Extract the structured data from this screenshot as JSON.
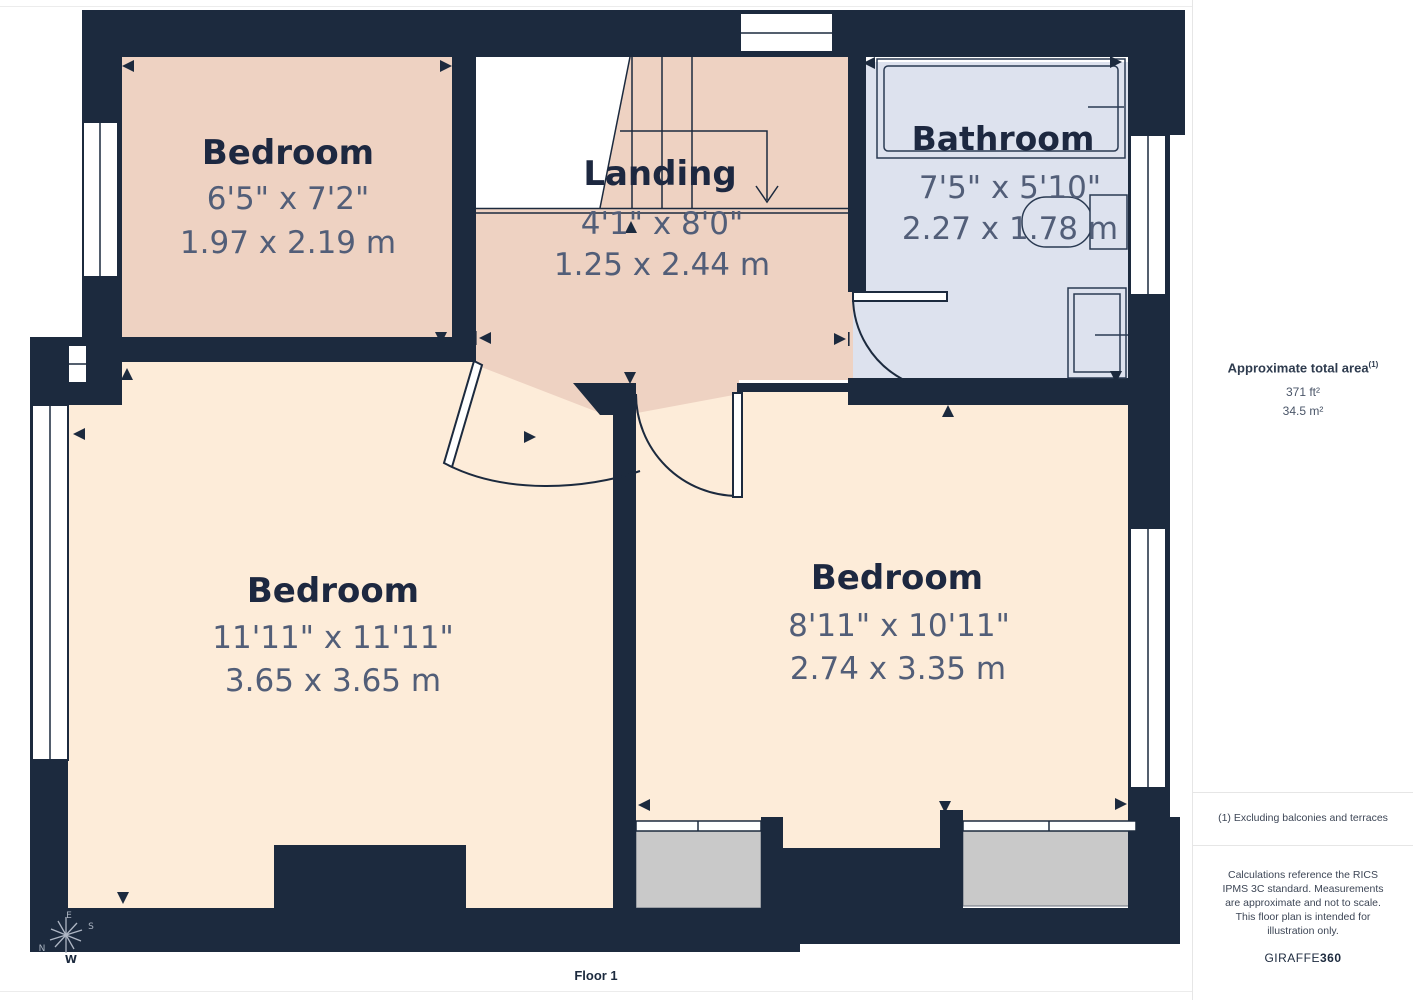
{
  "floor_label": "Floor 1",
  "rooms": [
    {
      "name": "Bedroom",
      "imperial": "6'5\" x 7'2\"",
      "metric": "1.97 x 2.19 m"
    },
    {
      "name": "Landing",
      "imperial": "4'1\" x 8'0\"",
      "metric": "1.25 x 2.44 m"
    },
    {
      "name": "Bathroom",
      "imperial": "7'5\" x 5'10\"",
      "metric": "2.27 x 1.78 m"
    },
    {
      "name": "Bedroom",
      "imperial": "11'11\" x 11'11\"",
      "metric": "3.65 x 3.65 m"
    },
    {
      "name": "Bedroom",
      "imperial": "8'11\" x 10'11\"",
      "metric": "2.74 x 3.35 m"
    }
  ],
  "sidebar": {
    "total_area_label": "Approximate total area",
    "total_area_superscript": "(1)",
    "area_ft": "371 ft²",
    "area_m": "34.5 m²",
    "footnote": "(1) Excluding balconies and terraces",
    "disclaimer": "Calculations reference the RICS IPMS 3C standard. Measurements are approximate and not to scale. This floor plan is intended for illustration only.",
    "brand_regular": "GIRAFFE",
    "brand_bold": "360"
  },
  "compass": {
    "n": "N",
    "e": "E",
    "s": "S",
    "w": "W"
  },
  "colors": {
    "wall": "#1c2a3e",
    "room_pink": "#eed2c2",
    "room_cream": "#fdecd9",
    "room_blue": "#dde2ee",
    "porch_gray": "#c9c9c9",
    "dim_text": "#525e78",
    "name_text": "#1d2840"
  }
}
